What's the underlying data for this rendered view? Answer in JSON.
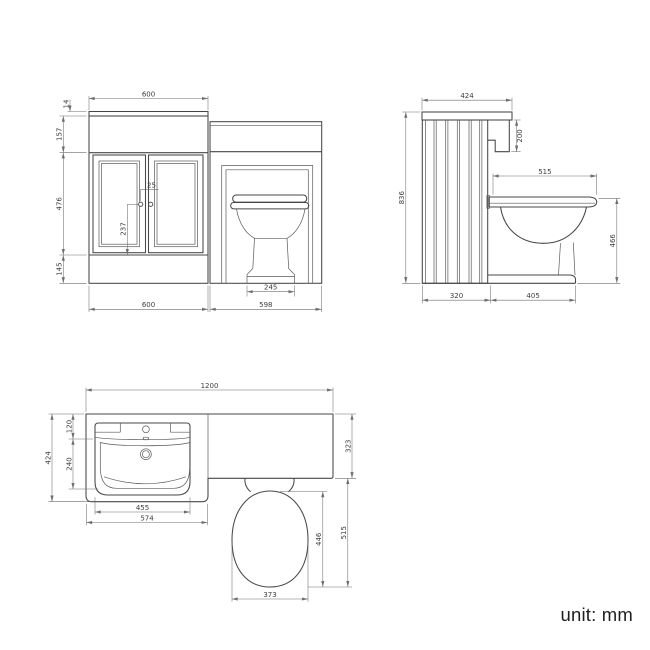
{
  "unit_label": "unit: mm",
  "front_view": {
    "top_width": "600",
    "worktop_thickness": "14",
    "upstand_height": "157",
    "door_height": "476",
    "plinth_height": "145",
    "handle_offset": "25",
    "handle_position": "237",
    "vanity_width": "600",
    "wc_unit_width": "598",
    "pedestal_width": "245"
  },
  "side_view": {
    "worktop_depth": "424",
    "basin_drop": "200",
    "overall_height": "836",
    "seat_depth": "515",
    "seat_height": "466",
    "cabinet_depth": "320",
    "toilet_projection": "405"
  },
  "plan_view": {
    "overall_width": "1200",
    "vanity_depth": "424",
    "deck_depth": "120",
    "bowl_depth": "240",
    "worktop_depth": "323",
    "bowl_width": "455",
    "basin_width": "574",
    "toilet_projection": "515",
    "seat_length": "446",
    "seat_width": "373"
  }
}
